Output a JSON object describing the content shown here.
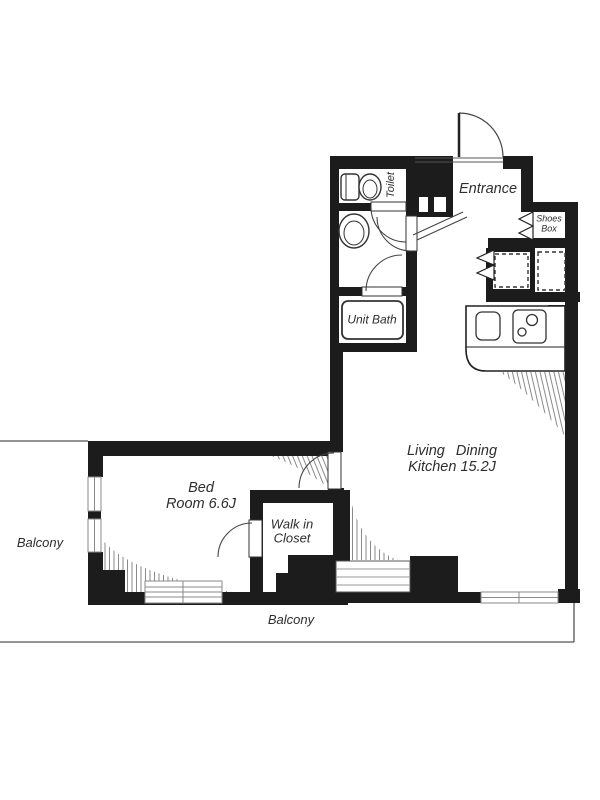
{
  "rooms": {
    "toilet": {
      "label": "Toilet"
    },
    "entrance": {
      "label": "Entrance"
    },
    "shoes_box": {
      "line1": "Shoes",
      "line2": "Box"
    },
    "unit_bath": {
      "label": "Unit Bath"
    },
    "living_dining_kitchen": {
      "line1": "Living Dining",
      "line2": "Kitchen 15.2J"
    },
    "bedroom": {
      "line1": "Bed",
      "line2": "Room 6.6J"
    },
    "walk_in_closet": {
      "line1": "Walk in",
      "line2": "Closet"
    },
    "balcony_left": {
      "label": "Balcony"
    },
    "balcony_bottom": {
      "label": "Balcony"
    }
  },
  "fixtures": [
    "toilet-fixture",
    "washbasin",
    "unit-bath-tub",
    "kitchen-sink",
    "gas-stove-2-burner",
    "entrance-swing-door",
    "shoes-box-folding-door",
    "storage-folding-door",
    "washer-space-dashed",
    "fridge-space-dashed",
    "sliding-windows"
  ],
  "colors": {
    "wall": "#1c1c1c",
    "thin_line": "#555555",
    "window_line": "#8a8a8a",
    "hatch_line": "#8a8a8a",
    "text": "#2e2e2e",
    "background": "#ffffff"
  }
}
